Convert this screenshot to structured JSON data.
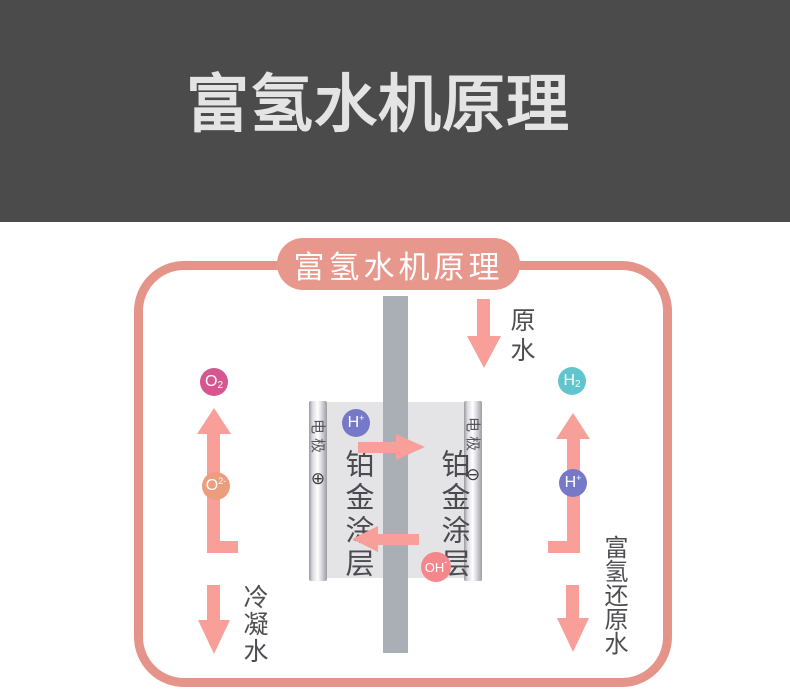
{
  "header": {
    "title": "富氢水机原理",
    "bg_color": "#4b4b4b",
    "text_color": "#e4e4e4"
  },
  "diagram": {
    "pill_title": "富氢水机原理",
    "colors": {
      "frame_accent": "#e5948a",
      "arrow": "#f79f98",
      "membrane": "#aaaeb5",
      "cell_bg": "#e4e4e7"
    },
    "membrane": {
      "label_top": "SPE膜",
      "label_bottom": "SPE膜"
    },
    "cell": {
      "coating_left": "铂金涂层",
      "coating_right": "铂金涂层"
    },
    "electrode_left": {
      "label": "电极",
      "symbol": "⊕"
    },
    "electrode_right": {
      "label": "电极",
      "symbol": "⊖"
    },
    "flow_labels": {
      "raw_water": "原水",
      "condensed_water": "冷凝水",
      "hydrogen_rich_water": "富氢还原水"
    },
    "particles": {
      "o2": {
        "main": "O",
        "sub": "2",
        "color": "#d4578f"
      },
      "o2_minus": {
        "main": "O",
        "sup": "2-",
        "color": "#ec9d7e"
      },
      "h_plus_left": {
        "main": "H",
        "sup": "+",
        "color": "#7678c8"
      },
      "oh_minus": {
        "main": "OH",
        "sup": "-",
        "color": "#f4878c"
      },
      "h2": {
        "main": "H",
        "sub": "2",
        "color": "#62c5ce"
      },
      "h_plus_right": {
        "main": "H",
        "sup": "+",
        "color": "#7678c8"
      }
    }
  }
}
